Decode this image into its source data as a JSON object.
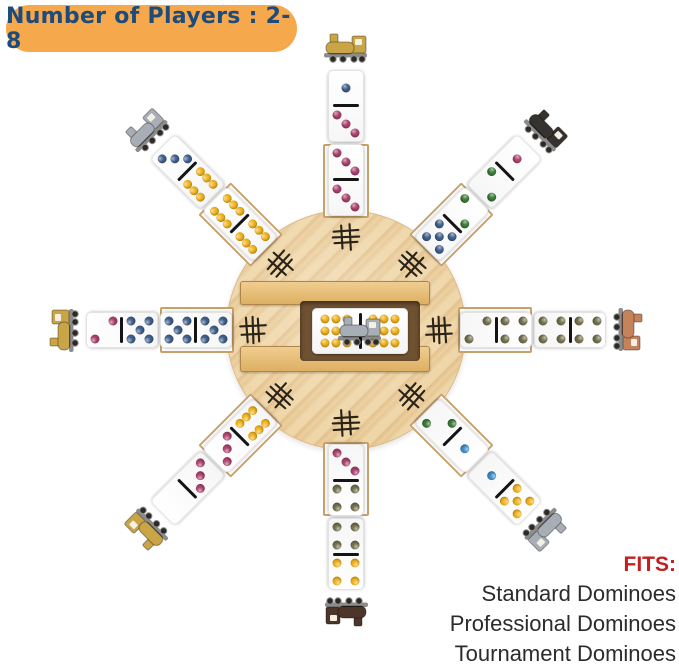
{
  "banner": {
    "text": "Number of Players : 2-8",
    "bg_color": "#f6a84c",
    "text_color": "#1d4b7b"
  },
  "fits": {
    "title": "FITS:",
    "title_color": "#c21f1f",
    "items": [
      "Standard Dominoes",
      "Professional Dominoes",
      "Tournament Dominoes"
    ]
  },
  "pip_colors": {
    "pink": "#ad4370",
    "blue": "#41618c",
    "lightblue": "#3e8ec9",
    "yellow": "#f1b41e",
    "green": "#3c7a38",
    "olive": "#75734f"
  },
  "hub": {
    "wood_color": "#efd6a8",
    "wood_stripe_color": "#e2bf8a",
    "tally_marks": {
      "count": 8,
      "color": "#2a2318"
    },
    "center": {
      "train": {
        "name": "silver-train",
        "color": "#a8aeb5"
      },
      "domino": {
        "halves": [
          {
            "count": 9,
            "color": "yellow"
          },
          {
            "count": 9,
            "color": "yellow"
          }
        ]
      }
    }
  },
  "arms": [
    {
      "id": "north",
      "angle": 0,
      "train": {
        "name": "gold-train",
        "color": "#c9a548"
      },
      "dominoes": [
        {
          "halves": [
            {
              "count": 1,
              "color": "blue"
            },
            {
              "count": 3,
              "color": "pink"
            }
          ]
        },
        {
          "halves": [
            {
              "count": 3,
              "color": "pink"
            },
            {
              "count": 3,
              "color": "pink"
            }
          ]
        }
      ]
    },
    {
      "id": "northeast",
      "angle": 45,
      "train": {
        "name": "black-train",
        "color": "#35322f"
      },
      "dominoes": [
        {
          "halves": [
            {
              "count": 1,
              "color": "pink"
            },
            {
              "count": 2,
              "color": "green"
            }
          ]
        },
        {
          "halves": [
            {
              "count": 2,
              "color": "green"
            },
            {
              "count": 5,
              "color": "blue"
            }
          ]
        }
      ]
    },
    {
      "id": "east",
      "angle": 90,
      "train": {
        "name": "copper-train",
        "color": "#c5835c"
      },
      "dominoes": [
        {
          "halves": [
            {
              "count": 4,
              "color": "olive"
            },
            {
              "count": 4,
              "color": "olive"
            }
          ]
        },
        {
          "halves": [
            {
              "count": 4,
              "color": "olive"
            },
            {
              "count": 2,
              "color": "olive"
            }
          ]
        }
      ]
    },
    {
      "id": "southeast",
      "angle": 135,
      "train": {
        "name": "silver-train",
        "color": "#a8aeb5"
      },
      "dominoes": [
        {
          "halves": [
            {
              "count": 5,
              "color": "yellow"
            },
            {
              "count": 1,
              "color": "lightblue"
            }
          ]
        },
        {
          "halves": [
            {
              "count": 1,
              "color": "lightblue"
            },
            {
              "count": 2,
              "color": "green"
            }
          ]
        }
      ]
    },
    {
      "id": "south",
      "angle": 180,
      "train": {
        "name": "brown-train",
        "color": "#4e352a"
      },
      "dominoes": [
        {
          "halves": [
            {
              "count": 4,
              "color": "yellow"
            },
            {
              "count": 4,
              "color": "olive"
            }
          ]
        },
        {
          "halves": [
            {
              "count": 4,
              "color": "olive"
            },
            {
              "count": 3,
              "color": "pink"
            }
          ]
        }
      ]
    },
    {
      "id": "southwest",
      "angle": 225,
      "train": {
        "name": "gold-train",
        "color": "#c9a548"
      },
      "dominoes": [
        {
          "halves": [
            {
              "count": 0,
              "color": "pink"
            },
            {
              "count": 3,
              "color": "pink"
            }
          ]
        },
        {
          "halves": [
            {
              "count": 3,
              "color": "pink"
            },
            {
              "count": 6,
              "color": "yellow"
            }
          ]
        }
      ]
    },
    {
      "id": "west",
      "angle": 270,
      "train": {
        "name": "gold-train",
        "color": "#c9a548"
      },
      "dominoes": [
        {
          "halves": [
            {
              "count": 2,
              "color": "pink"
            },
            {
              "count": 5,
              "color": "blue"
            }
          ]
        },
        {
          "halves": [
            {
              "count": 5,
              "color": "blue"
            },
            {
              "count": 5,
              "color": "blue"
            }
          ]
        }
      ]
    },
    {
      "id": "northwest",
      "angle": 315,
      "train": {
        "name": "silver-train",
        "color": "#a8aeb5"
      },
      "dominoes": [
        {
          "halves": [
            {
              "count": 3,
              "color": "blue"
            },
            {
              "count": 6,
              "color": "yellow"
            }
          ]
        },
        {
          "halves": [
            {
              "count": 6,
              "color": "yellow"
            },
            {
              "count": 6,
              "color": "yellow"
            }
          ]
        }
      ]
    }
  ]
}
